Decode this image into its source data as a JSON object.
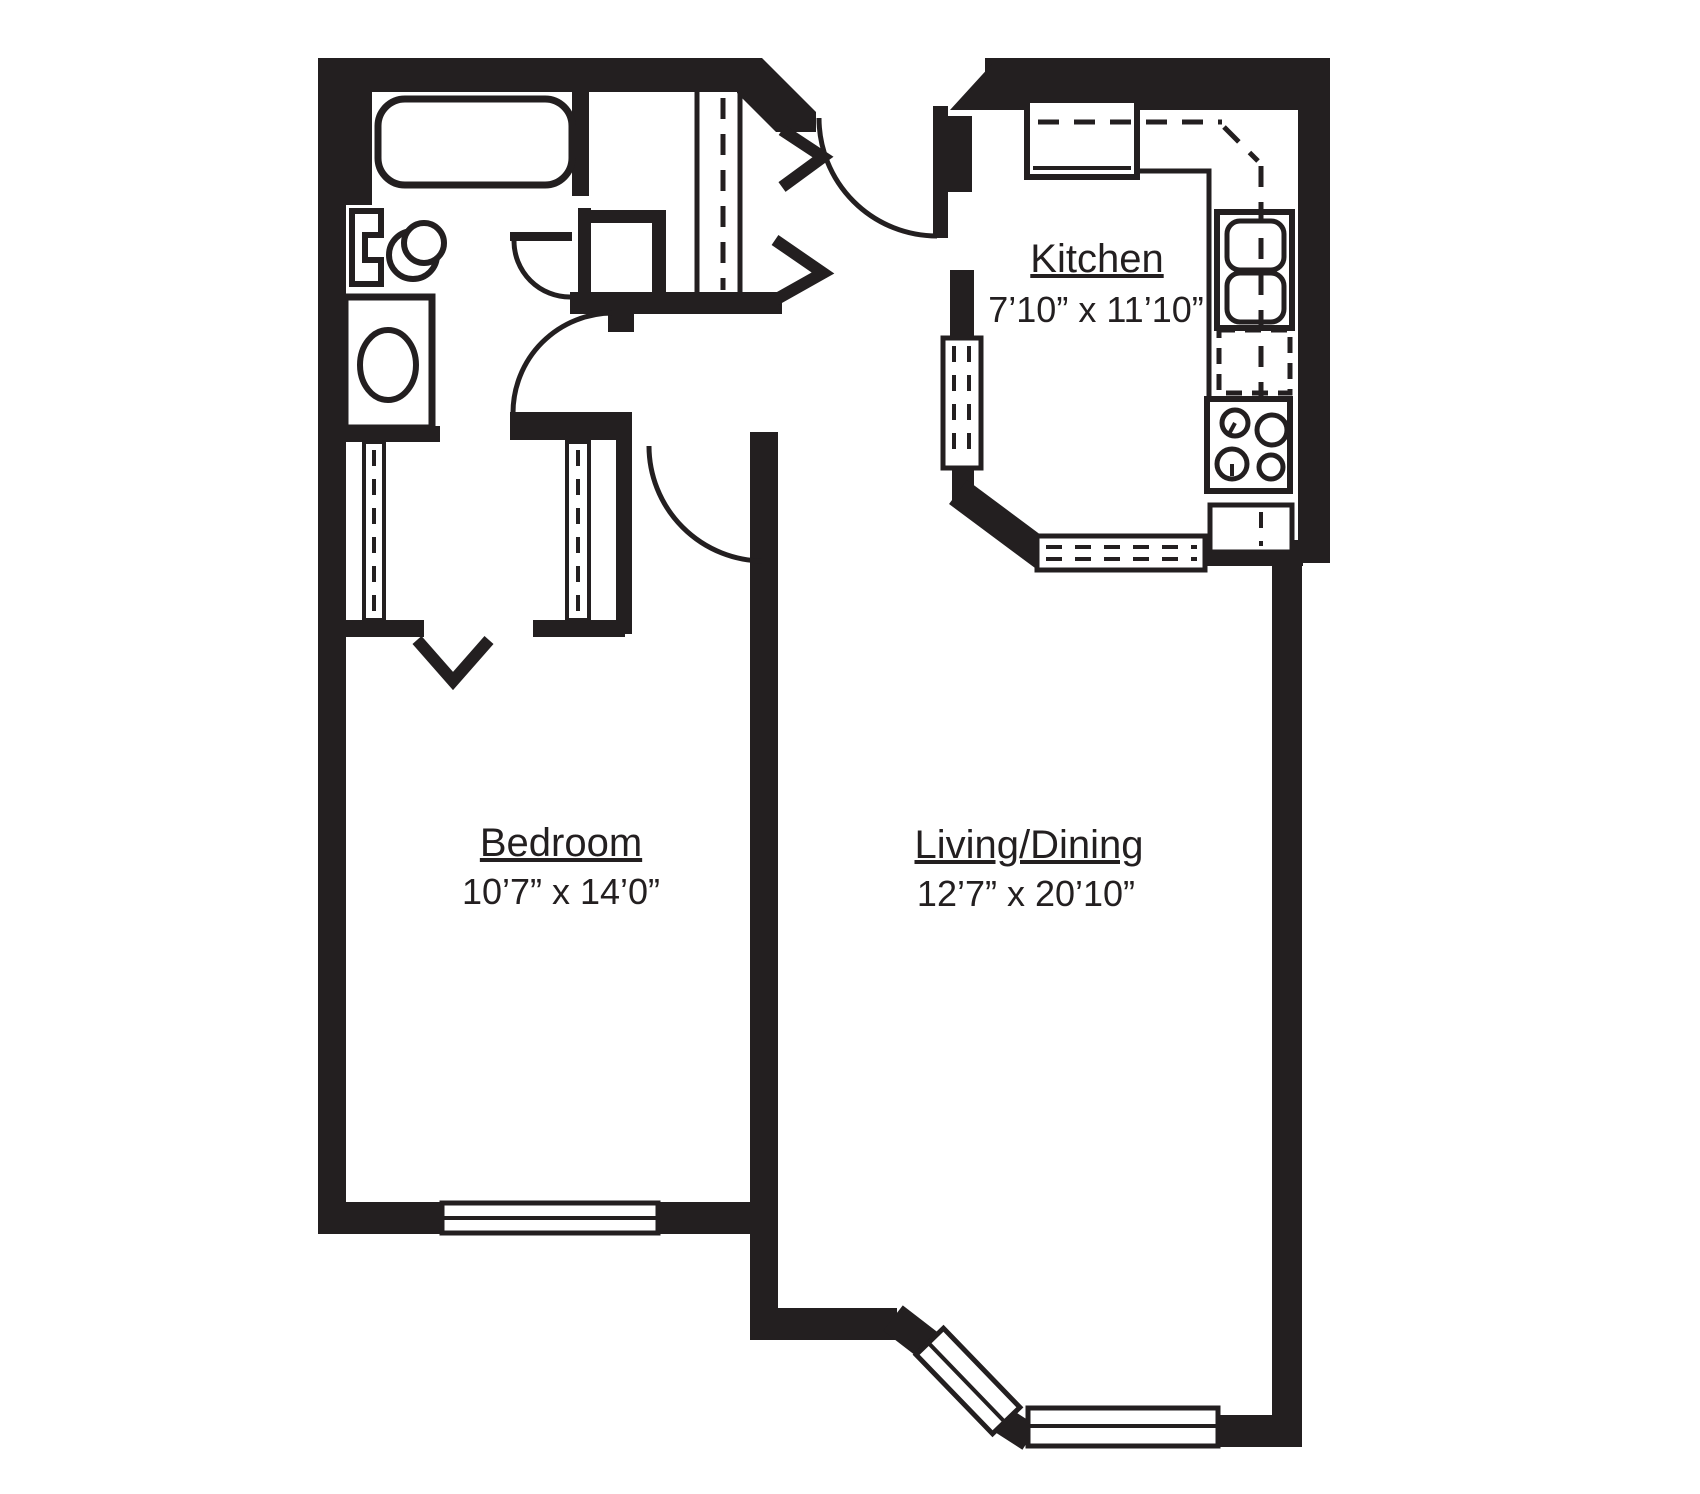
{
  "diagram": {
    "type": "floor-plan",
    "background_color": "#ffffff",
    "wall_color": "#231f20",
    "rooms": {
      "kitchen": {
        "label": "Kitchen",
        "dimensions": "7’10” x 11’10”"
      },
      "bedroom": {
        "label": "Bedroom",
        "dimensions": "10’7” x 14’0”"
      },
      "living_dining": {
        "label": "Living/Dining",
        "dimensions": "12’7” x 20’10”"
      }
    },
    "fixtures": [
      "bathtub",
      "toilet",
      "washer",
      "refrigerator",
      "kitchen-sink",
      "dishwasher",
      "stove",
      "base-cabinet",
      "counter"
    ],
    "symbols": [
      "door-swing-arc",
      "entry-chevron",
      "closet-rod-dashed-line",
      "upper-cabinet-dashed-line",
      "window-double-line",
      "closet-entry-arrow"
    ]
  }
}
